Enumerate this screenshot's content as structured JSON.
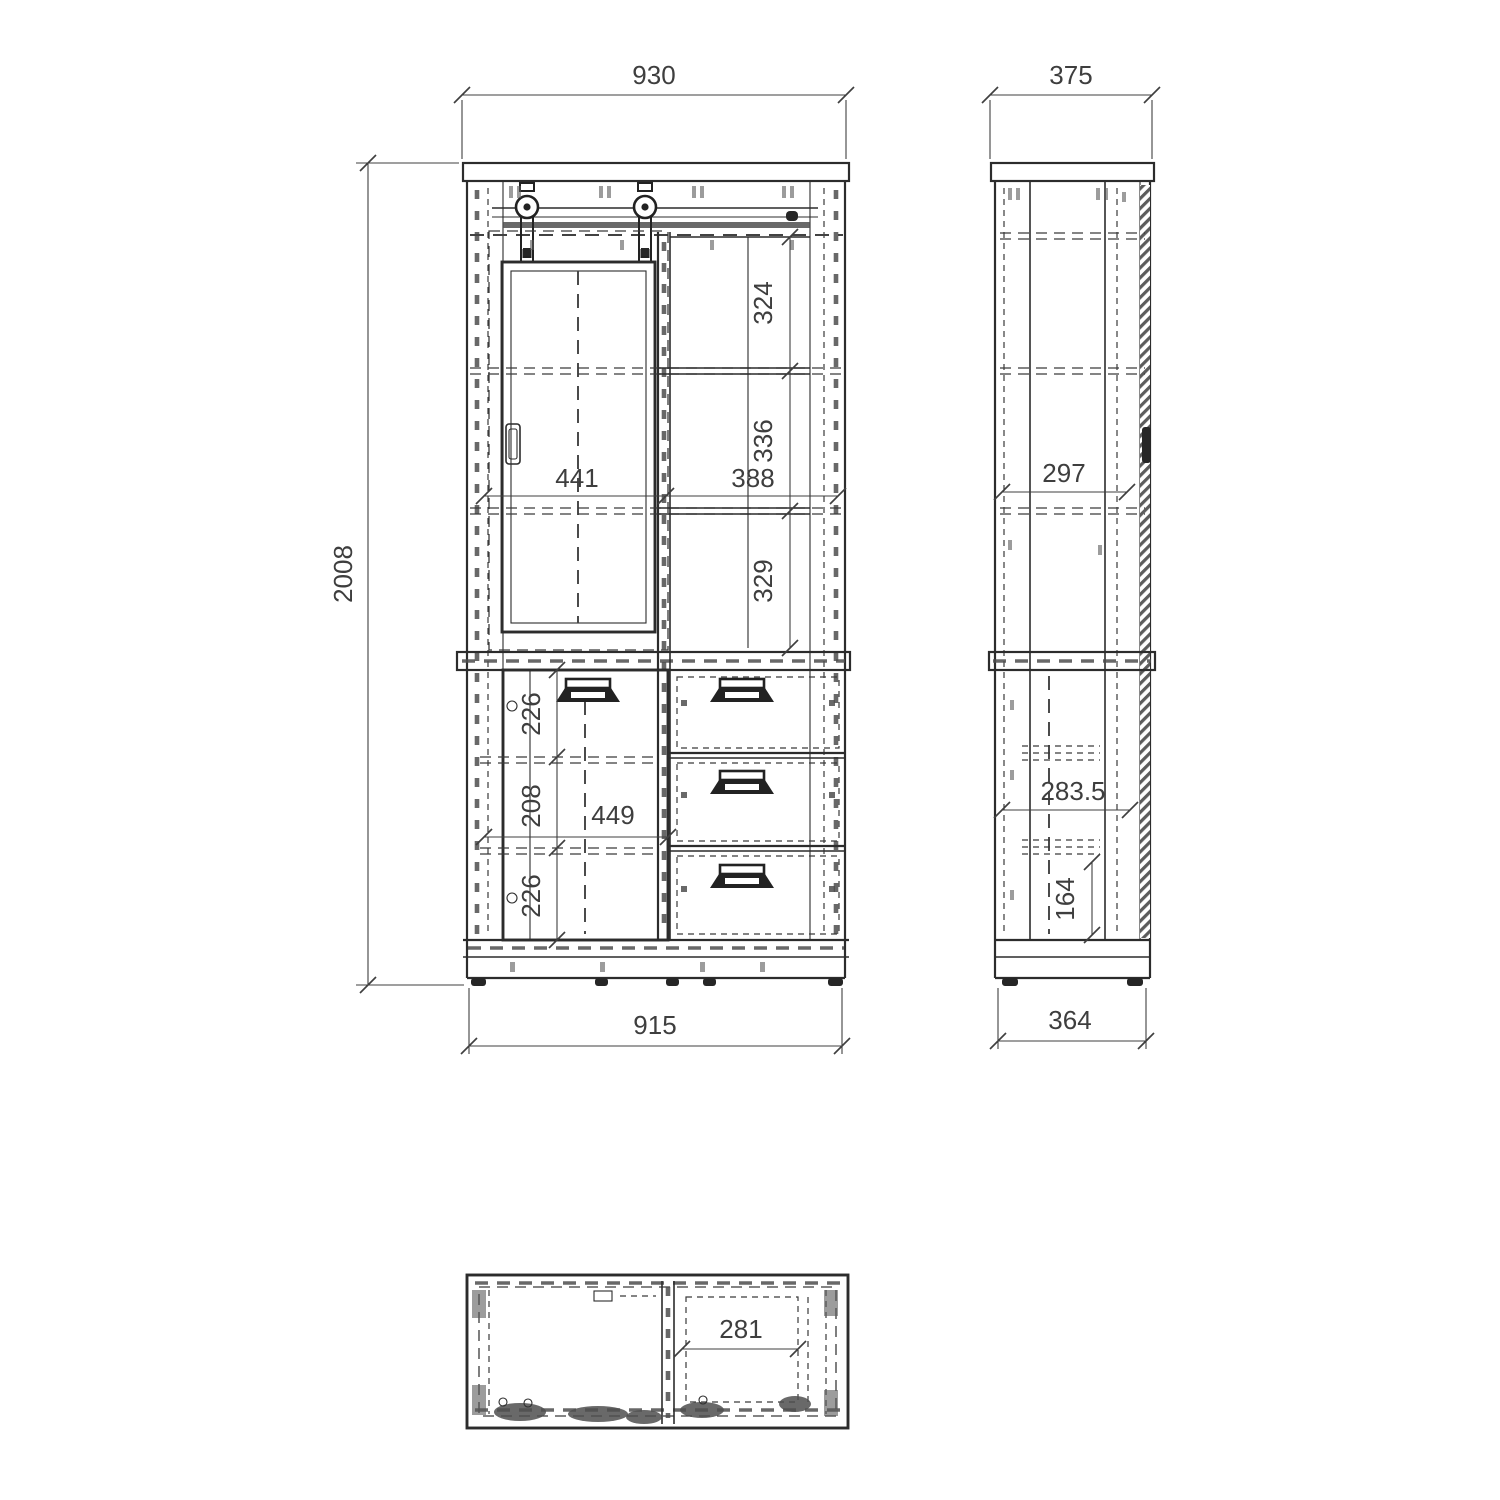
{
  "drawing": {
    "type": "furniture-technical-drawing",
    "colors": {
      "line": "#2c2c2c",
      "dim_text": "#3e3e3e",
      "hatch": "#4f4f4f",
      "background": "#ffffff"
    },
    "front_view": {
      "dims": {
        "overall_width_top": "930",
        "overall_height": "2008",
        "overall_width_bottom": "915",
        "upper_door_width": "441",
        "upper_shelf_width": "388",
        "upper_shelf_top_height": "324",
        "upper_shelf_middle_height": "336",
        "upper_shelf_bottom_height": "329",
        "lower_compartment_top_height": "226",
        "lower_compartment_middle_height": "208",
        "lower_compartment_bottom_height": "226",
        "lower_door_width": "449"
      }
    },
    "side_view": {
      "dims": {
        "overall_depth_top": "375",
        "inner_depth_upper": "297",
        "inner_depth_lower": "283.5",
        "drawer_inner_height": "164",
        "overall_depth_bottom": "364"
      }
    },
    "top_view": {
      "dims": {
        "drawer_bay_width": "281"
      }
    }
  }
}
